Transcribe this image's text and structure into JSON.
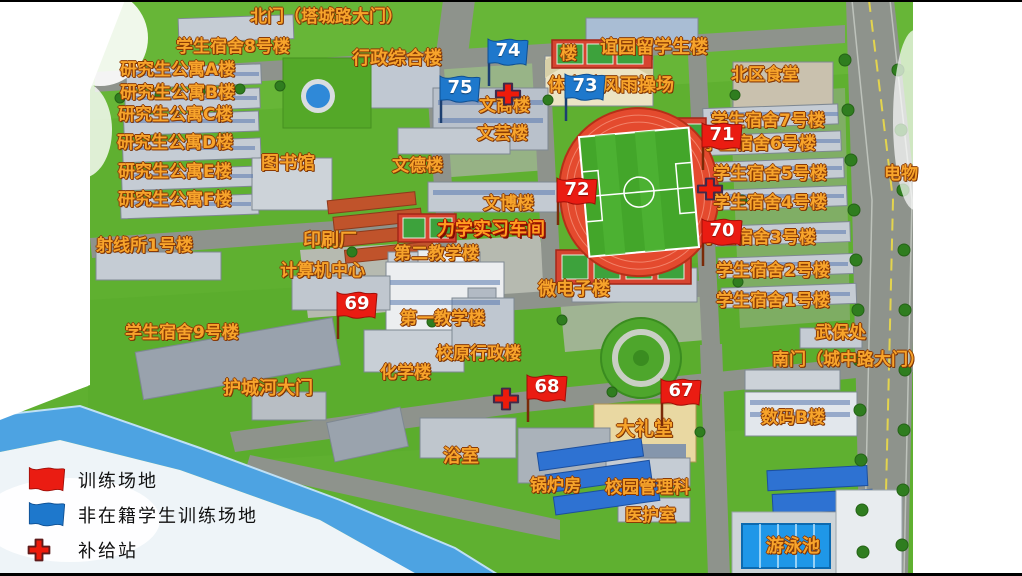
{
  "legend": {
    "items": [
      {
        "icon": "red-flag-icon",
        "label": "训练场地"
      },
      {
        "icon": "blue-flag-icon",
        "label": "非在籍学生训练场地"
      },
      {
        "icon": "red-cross-icon",
        "label": "补给站"
      }
    ]
  },
  "colors": {
    "label_fill": "#f7a42b",
    "label_outline": "#8b3a05",
    "red_flag": "#ea1c12",
    "blue_flag": "#1e78cc",
    "cross_red": "#ee1b0b",
    "stadium_track": "#e44a2e",
    "stadium_field": "#43a62a"
  },
  "map": {
    "labels": [
      {
        "text": "北门（塔城路大门）",
        "x": 250,
        "y": 9,
        "fs": 17
      },
      {
        "text": "学生宿舍8号楼",
        "x": 176,
        "y": 39,
        "fs": 17
      },
      {
        "text": "研究生公寓A楼",
        "x": 120,
        "y": 62,
        "fs": 17
      },
      {
        "text": "研究生公寓B楼",
        "x": 120,
        "y": 85,
        "fs": 17
      },
      {
        "text": "研究生公寓C楼",
        "x": 118,
        "y": 107,
        "fs": 17
      },
      {
        "text": "研究生公寓D楼",
        "x": 117,
        "y": 135,
        "fs": 17
      },
      {
        "text": "研究生公寓E楼",
        "x": 118,
        "y": 164,
        "fs": 17
      },
      {
        "text": "研究生公寓F楼",
        "x": 118,
        "y": 192,
        "fs": 17
      },
      {
        "text": "行政综合楼",
        "x": 352,
        "y": 50,
        "fs": 18
      },
      {
        "text": "谊园留学生楼",
        "x": 600,
        "y": 39,
        "fs": 18
      },
      {
        "text": "楼",
        "x": 560,
        "y": 46,
        "fs": 17
      },
      {
        "text": "北区食堂",
        "x": 731,
        "y": 67,
        "fs": 17
      },
      {
        "text": "体育馆风雨操场",
        "x": 548,
        "y": 77,
        "fs": 18
      },
      {
        "text": "文商楼",
        "x": 479,
        "y": 98,
        "fs": 17
      },
      {
        "text": "文芸楼",
        "x": 477,
        "y": 126,
        "fs": 17
      },
      {
        "text": "学生宿舍7号楼",
        "x": 711,
        "y": 113,
        "fs": 17
      },
      {
        "text": "学生宿舍6号楼",
        "x": 702,
        "y": 136,
        "fs": 17
      },
      {
        "text": "图书馆",
        "x": 261,
        "y": 155,
        "fs": 18
      },
      {
        "text": "文德楼",
        "x": 392,
        "y": 158,
        "fs": 17
      },
      {
        "text": "学生宿舍5号楼",
        "x": 713,
        "y": 166,
        "fs": 17
      },
      {
        "text": "电物",
        "x": 884,
        "y": 166,
        "fs": 17
      },
      {
        "text": "文博楼",
        "x": 483,
        "y": 196,
        "fs": 17
      },
      {
        "text": "学生宿舍4号楼",
        "x": 713,
        "y": 195,
        "fs": 17
      },
      {
        "text": "力学实习车间",
        "x": 437,
        "y": 221,
        "fs": 18,
        "cls": "label-strong"
      },
      {
        "text": "学生宿舍3号楼",
        "x": 702,
        "y": 230,
        "fs": 17
      },
      {
        "text": "射线所1号楼",
        "x": 96,
        "y": 238,
        "fs": 17
      },
      {
        "text": "印刷厂",
        "x": 303,
        "y": 232,
        "fs": 18
      },
      {
        "text": "第二教学楼",
        "x": 394,
        "y": 246,
        "fs": 17
      },
      {
        "text": "计算机中心",
        "x": 280,
        "y": 263,
        "fs": 17
      },
      {
        "text": "学生宿舍2号楼",
        "x": 716,
        "y": 263,
        "fs": 17
      },
      {
        "text": "微电子楼",
        "x": 538,
        "y": 281,
        "fs": 18
      },
      {
        "text": "学生宿舍1号楼",
        "x": 716,
        "y": 293,
        "fs": 17
      },
      {
        "text": "第一教学楼",
        "x": 400,
        "y": 311,
        "fs": 17
      },
      {
        "text": "学生宿舍9号楼",
        "x": 125,
        "y": 325,
        "fs": 17
      },
      {
        "text": "武保处",
        "x": 815,
        "y": 325,
        "fs": 17
      },
      {
        "text": "校原行政楼",
        "x": 436,
        "y": 346,
        "fs": 17
      },
      {
        "text": "南门（城中路大门）",
        "x": 772,
        "y": 352,
        "fs": 17
      },
      {
        "text": "化学楼",
        "x": 380,
        "y": 365,
        "fs": 17
      },
      {
        "text": "护城河大门",
        "x": 223,
        "y": 380,
        "fs": 18
      },
      {
        "text": "数码B楼",
        "x": 761,
        "y": 410,
        "fs": 17
      },
      {
        "text": "大礼堂",
        "x": 616,
        "y": 420,
        "fs": 19
      },
      {
        "text": "浴室",
        "x": 443,
        "y": 448,
        "fs": 18
      },
      {
        "text": "锅炉房",
        "x": 530,
        "y": 478,
        "fs": 17
      },
      {
        "text": "校园管理科",
        "x": 605,
        "y": 480,
        "fs": 17
      },
      {
        "text": "医护室",
        "x": 625,
        "y": 508,
        "fs": 17
      },
      {
        "text": "游泳池",
        "x": 766,
        "y": 538,
        "fs": 18
      }
    ],
    "markers": [
      {
        "num": "67",
        "color": "red",
        "x": 658,
        "y": 376
      },
      {
        "num": "68",
        "color": "red",
        "x": 524,
        "y": 372
      },
      {
        "num": "69",
        "color": "red",
        "x": 334,
        "y": 289
      },
      {
        "num": "70",
        "color": "red",
        "x": 699,
        "y": 216
      },
      {
        "num": "71",
        "color": "red",
        "x": 699,
        "y": 120
      },
      {
        "num": "72",
        "color": "red",
        "x": 554,
        "y": 175
      },
      {
        "num": "73",
        "color": "blue",
        "x": 562,
        "y": 71
      },
      {
        "num": "74",
        "color": "blue",
        "x": 485,
        "y": 36
      },
      {
        "num": "75",
        "color": "blue",
        "x": 437,
        "y": 73
      }
    ],
    "crosses": [
      {
        "x": 493,
        "y": 81
      },
      {
        "x": 695,
        "y": 176
      },
      {
        "x": 491,
        "y": 386
      }
    ]
  }
}
